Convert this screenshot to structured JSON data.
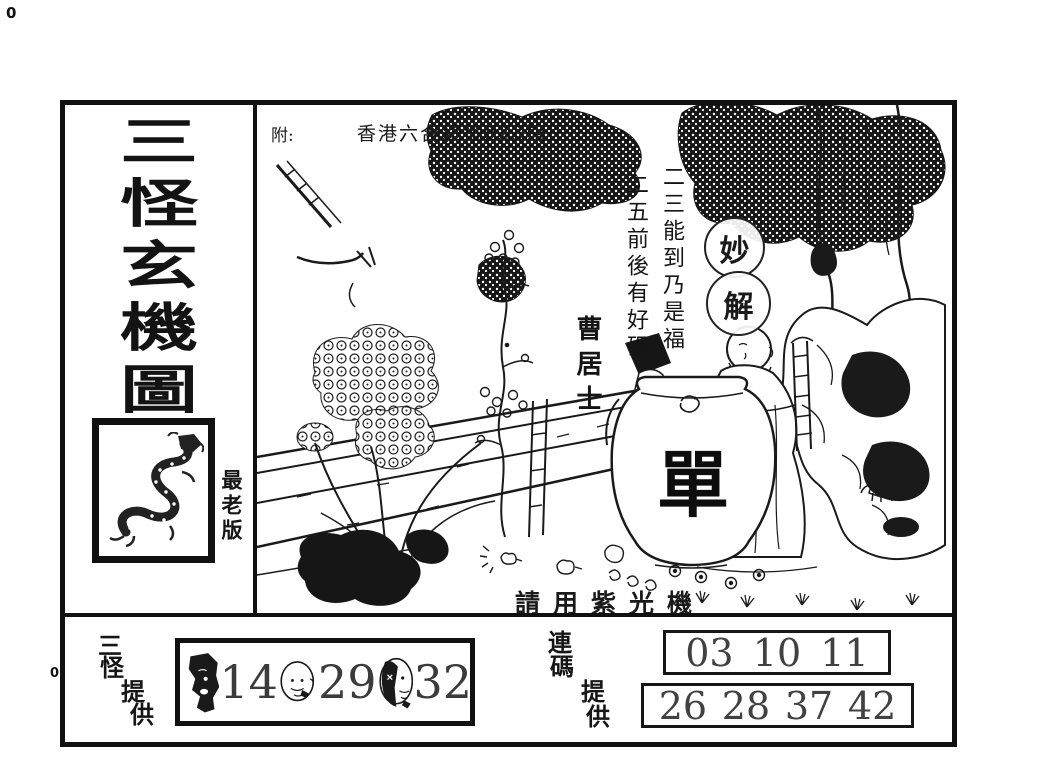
{
  "artifacts": {
    "corner_mark": "0",
    "margin_mark": "0"
  },
  "header": {
    "prefix": "附:",
    "issue": "香港六合彩第023期"
  },
  "sidebar": {
    "title_chars": [
      "三",
      "怪",
      "玄",
      "機",
      "圖"
    ],
    "edition": "最老版",
    "dragon_icon": "dragon"
  },
  "illustration": {
    "poem_right": "二三能到乃是福",
    "poem_left": "二五前後有好碼",
    "seal_top": "妙",
    "seal_bottom": "解",
    "signature": "曹居士",
    "jar_character": "單",
    "footer_note": "請用紫光機"
  },
  "providers": {
    "left": {
      "label_chars": [
        "三",
        "怪",
        "提",
        "供"
      ],
      "numbers": [
        "14",
        "29",
        "32"
      ]
    },
    "right": {
      "label_chars": [
        "連",
        "碼",
        "提",
        "供"
      ],
      "row1": [
        "03",
        "10",
        "11"
      ],
      "row2": [
        "26",
        "28",
        "37",
        "42"
      ]
    }
  },
  "colors": {
    "ink": "#1a1a1a",
    "paper": "#ffffff",
    "number_ink": "#3b3b3b"
  }
}
